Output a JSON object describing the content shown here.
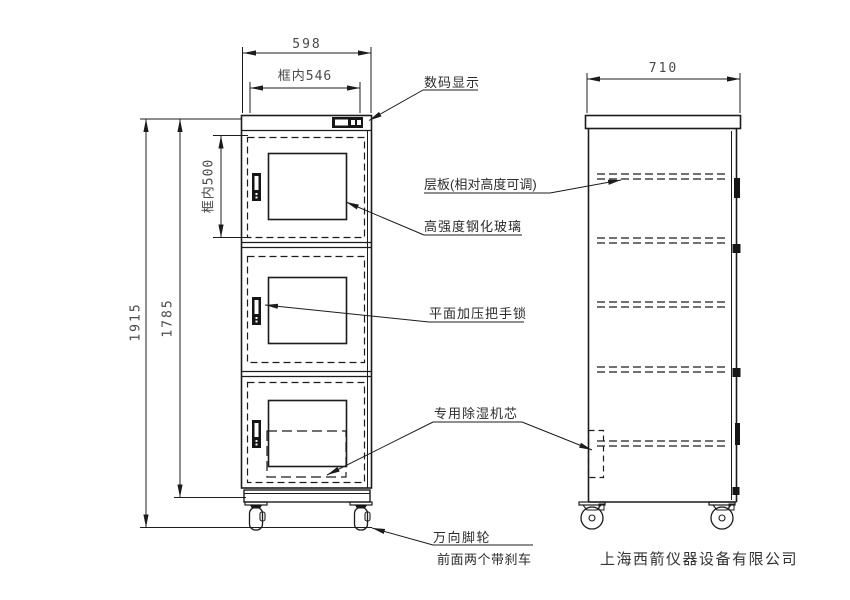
{
  "drawing": {
    "dimensions": {
      "front_width": "598",
      "front_inner_width": "框内546",
      "front_inner_height": "框内500",
      "total_height": "1915",
      "body_height": "1785",
      "side_depth": "710"
    },
    "callouts": {
      "digital_display": "数码显示",
      "shelf": "层板(相对高度可调)",
      "tempered_glass": "高强度钢化玻璃",
      "handle_lock": "平面加压把手锁",
      "dehumidifier_core": "专用除湿机芯",
      "casters_line1": "万向脚轮",
      "casters_line2": "前面两个带刹车"
    },
    "company": "上海西箭仪器设备有限公司",
    "colors": {
      "line": "#1c1c1c",
      "dim_text": "#4a4a4a",
      "label_text": "#2b2b2b",
      "background": "#ffffff"
    }
  }
}
